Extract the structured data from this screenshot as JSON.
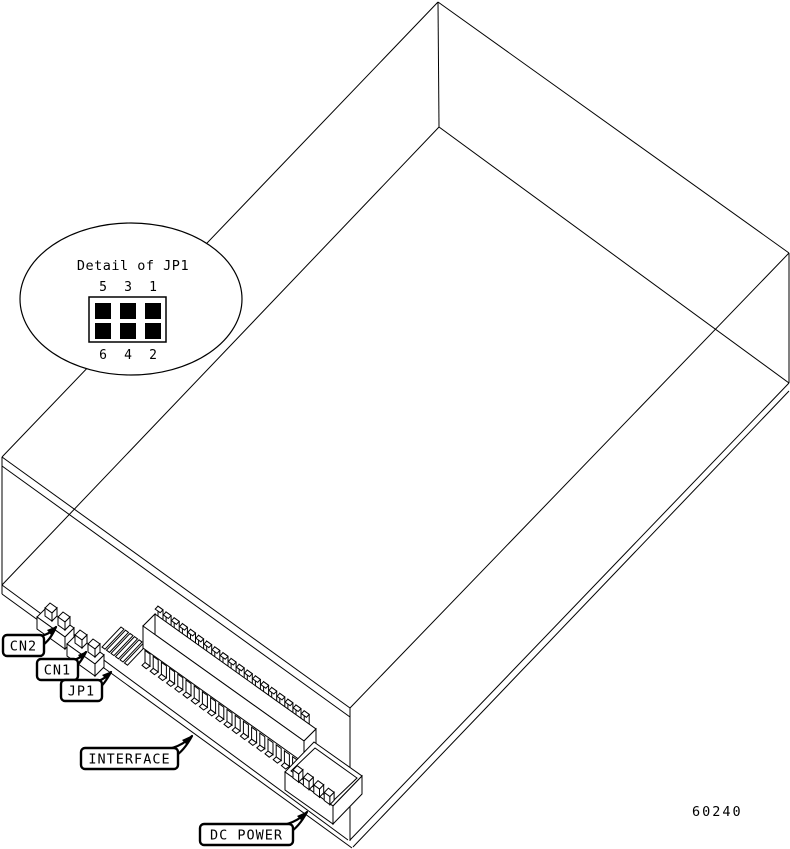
{
  "figure": {
    "number": "60240",
    "detail": {
      "title": "Detail of JP1",
      "pins_top": [
        "5",
        "3",
        "1"
      ],
      "pins_bottom": [
        "6",
        "4",
        "2"
      ]
    },
    "callouts": [
      {
        "id": "cn2",
        "label": "CN2"
      },
      {
        "id": "cn1",
        "label": "CN1"
      },
      {
        "id": "jp1",
        "label": "JP1"
      },
      {
        "id": "interface",
        "label": "INTERFACE"
      },
      {
        "id": "dc_power",
        "label": "DC POWER"
      }
    ],
    "colors": {
      "line": "#000000",
      "background": "#ffffff"
    }
  }
}
